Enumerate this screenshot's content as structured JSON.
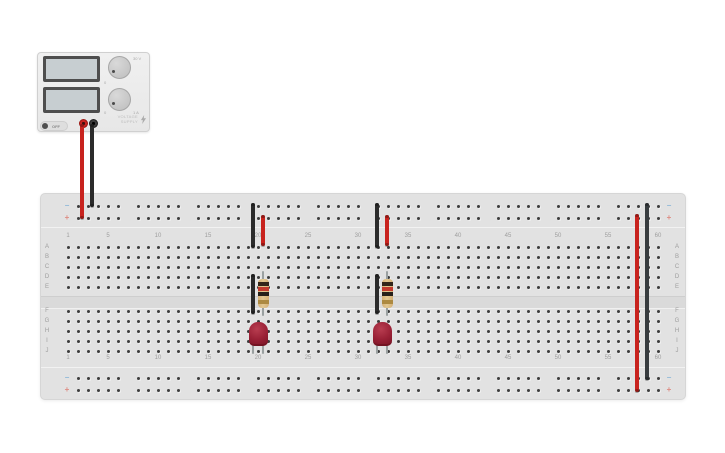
{
  "power_supply": {
    "off_button_label": "OFF",
    "brand_line1": "VOLTAGE",
    "brand_line2": "SUPPLY",
    "displays": [
      {
        "value": ""
      },
      {
        "value": ""
      }
    ],
    "knobs": [
      {
        "name": "voltage-knob",
        "min_label": "0",
        "max_label": "30 V"
      },
      {
        "name": "current-knob",
        "min_label": "0",
        "max_label": "1 A"
      }
    ],
    "terminal_positive_color": "#c8231e",
    "terminal_negative_color": "#2b2b2b"
  },
  "breadboard": {
    "rail_minus_sign": "−",
    "rail_plus_sign": "+",
    "row_letters_top": [
      "A",
      "B",
      "C",
      "D",
      "E"
    ],
    "row_letters_bottom": [
      "F",
      "G",
      "H",
      "I",
      "J"
    ],
    "column_label_numbers": [
      1,
      5,
      10,
      15,
      20,
      25,
      30,
      35,
      40,
      45,
      50,
      55,
      60
    ],
    "num_columns": 60,
    "rail_groups": 10,
    "rail_holes_per_group": 5
  },
  "styles": {
    "wire_red": "#c8231e",
    "wire_black": "#2b2b2b",
    "wire_dark_slate": "#383c3f",
    "resistor_body": "#d4b077",
    "resistor_bands": [
      "#33261a",
      "#c23b2e",
      "#26201a",
      "#ad8a41"
    ],
    "led_red": "#9e2335"
  },
  "components": [
    {
      "type": "wire",
      "name": "supply-positive-lead-wire",
      "color": "#c8231e",
      "x": 82,
      "y1": 124,
      "y2": 219
    },
    {
      "type": "wire",
      "name": "supply-negative-lead-wire",
      "color": "#2b2b2b",
      "x": 92,
      "y1": 124,
      "y2": 207
    },
    {
      "type": "wire",
      "name": "rail-to-row-black-wire-1",
      "color": "#2b2b2b",
      "x": 253,
      "y1": 203,
      "y2": 248
    },
    {
      "type": "wire",
      "name": "rail-to-row-red-wire-1",
      "color": "#c8231e",
      "x": 263,
      "y1": 215,
      "y2": 246
    },
    {
      "type": "wire",
      "name": "gap-jumper-black-wire-1",
      "color": "#2b2b2b",
      "x": 253,
      "y1": 274,
      "y2": 314
    },
    {
      "type": "resistor",
      "name": "resistor-1",
      "x": 263,
      "y1": 271,
      "y2": 316
    },
    {
      "type": "led",
      "name": "led-1",
      "x": 258,
      "y": 322
    },
    {
      "type": "wire",
      "name": "rail-to-row-black-wire-2",
      "color": "#2b2b2b",
      "x": 377,
      "y1": 203,
      "y2": 248
    },
    {
      "type": "wire",
      "name": "rail-to-row-red-wire-2",
      "color": "#c8231e",
      "x": 387,
      "y1": 215,
      "y2": 246
    },
    {
      "type": "wire",
      "name": "gap-jumper-black-wire-2",
      "color": "#2b2b2b",
      "x": 377,
      "y1": 274,
      "y2": 314
    },
    {
      "type": "resistor",
      "name": "resistor-2",
      "x": 387,
      "y1": 271,
      "y2": 316
    },
    {
      "type": "led",
      "name": "led-2",
      "x": 382,
      "y": 322
    },
    {
      "type": "wire",
      "name": "rail-to-rail-red-wire",
      "color": "#c8231e",
      "x": 637,
      "y1": 214,
      "y2": 392
    },
    {
      "type": "wire",
      "name": "rail-to-rail-black-wire",
      "color": "#383c3f",
      "x": 647,
      "y1": 203,
      "y2": 380
    }
  ]
}
